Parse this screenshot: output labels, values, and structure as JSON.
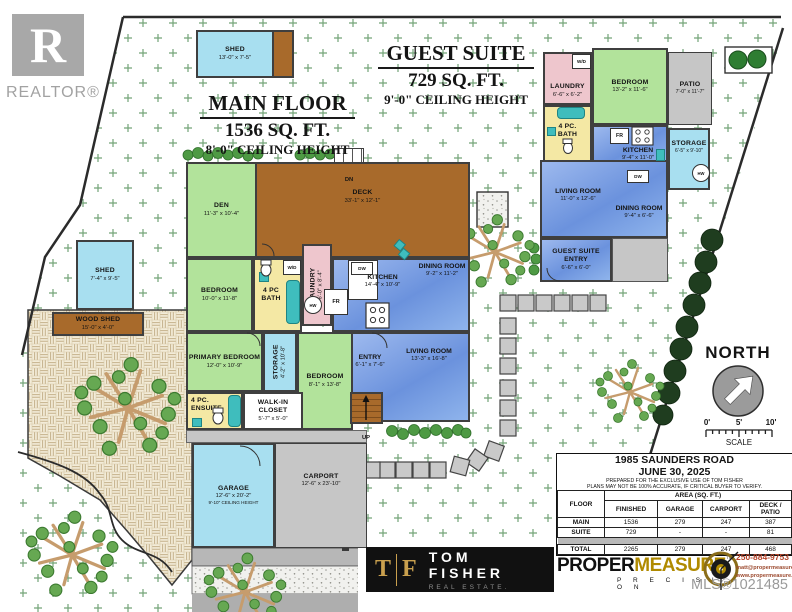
{
  "branding": {
    "realtor_r": "R",
    "realtor_word": "REALTOR®",
    "mls": "MLS®1021485",
    "tom_fisher": {
      "t": "T",
      "f": "F",
      "name": "TOM FISHER",
      "tagline": "REAL ESTATE."
    },
    "propermeasure": {
      "proper": "PROPER",
      "measure": "MEASURE",
      "tm": "™",
      "precision": "P R E C I S I O N"
    },
    "contact": {
      "phone": "250-884-9753",
      "email": "matt@propermeasure.com",
      "web": "www.propermeasure.com"
    }
  },
  "titles": {
    "main_floor": {
      "l1": "MAIN FLOOR",
      "l2": "1536 SQ. FT.",
      "l3": "8'-0\" CEILING HEIGHT"
    },
    "guest_suite": {
      "l1": "GUEST SUITE",
      "l2": "729 SQ. FT.",
      "l3": "9'-0\" CEILING HEIGHT"
    }
  },
  "compass": {
    "north": "NORTH",
    "scale": "SCALE",
    "ticks": [
      "0'",
      "5'",
      "10'"
    ]
  },
  "sheds": {
    "top": {
      "n": "SHED",
      "d": "13'-0\" x 7'-5\""
    },
    "left": {
      "n": "SHED",
      "d": "7'-4\" x 9'-5\""
    },
    "wood": {
      "n": "WOOD SHED",
      "d": "15'-0\" x 4'-0\""
    }
  },
  "main": {
    "den": {
      "n": "DEN",
      "d": "11'-3\" x 10'-4\""
    },
    "deck": {
      "n": "DECK",
      "d": "33'-1\" x 12'-1\"",
      "dn": "DN"
    },
    "bedroom": {
      "n": "BEDROOM",
      "d": "10'-0\" x 11'-8\""
    },
    "bath": {
      "n": "4 PC BATH"
    },
    "wd": "W/D",
    "hw": "HW",
    "fr": "FR",
    "dw": "DW",
    "up": "UP",
    "laundry": {
      "n": "LAUNDRY",
      "d": "6'-0\" x 8'-4\""
    },
    "kitchen": {
      "n": "KITCHEN",
      "d": "14'-4\" x 10'-9\""
    },
    "dining": {
      "n": "DINING ROOM",
      "d": "9'-2\" x 11'-2\""
    },
    "living": {
      "n": "LIVING ROOM",
      "d": "13'-3\" x 16'-8\""
    },
    "entry": {
      "n": "ENTRY",
      "d": "6'-1\" x 7'-6\""
    },
    "primary": {
      "n": "PRIMARY BEDROOM",
      "d": "12'-0\" x 10'-9\""
    },
    "storage": {
      "n": "STORAGE",
      "d": "4'-2\" x 10'-8\""
    },
    "bedroom2": {
      "n": "BEDROOM",
      "d": "8'-1\" x 13'-8\""
    },
    "ensuite": {
      "l1": "4 PC.",
      "l2": "ENSUITE"
    },
    "wic": {
      "n": "WALK-IN CLOSET",
      "d": "5'-7\" x 5'-0\""
    },
    "garage": {
      "n": "GARAGE",
      "d": "12'-6\" x 20'-2\"",
      "c": "9'-10\" CEILING HEIGHT"
    },
    "carport": {
      "n": "CARPORT",
      "d": "12'-6\" x 23'-10\""
    }
  },
  "guest": {
    "laundry": {
      "n": "LAUNDRY",
      "d": "6'-6\" x 6'-2\""
    },
    "wd": "W/D",
    "hw": "HW",
    "fr": "FR",
    "dw": "DW",
    "bedroom": {
      "n": "BEDROOM",
      "d": "13'-2\" x 11'-6\""
    },
    "patio": {
      "n": "PATIO",
      "d": "7'-0\" x 11'-7\""
    },
    "bath": {
      "n": "4 PC. BATH"
    },
    "kitchen": {
      "n": "KITCHEN",
      "d": "9'-4\" x 11'-0\""
    },
    "storage": {
      "n": "STORAGE",
      "d": "6'-5\" x 9'-10\""
    },
    "living": {
      "n": "LIVING ROOM",
      "d": "11'-0\" x 12'-6\""
    },
    "dining": {
      "n": "DINING ROOM",
      "d": "9'-4\" x 6'-6\""
    },
    "entry": {
      "n": "GUEST SUITE ENTRY",
      "d": "6'-6\" x 6'-0\""
    }
  },
  "table": {
    "address": "1985 SAUNDERS ROAD",
    "date": "JUNE 30, 2025",
    "note1": "PREPARED FOR THE EXCLUSIVE USE OF TOM FISHER",
    "note2": "PLANS MAY NOT BE 100% ACCURATE, IF CRITICAL BUYER TO VERIFY.",
    "floor_h": "FLOOR",
    "area_h": "AREA (SQ. FT.)",
    "cols": [
      "FINISHED",
      "GARAGE",
      "CARPORT",
      "DECK / PATIO"
    ],
    "rows": [
      {
        "label": "MAIN",
        "v": [
          "1536",
          "279",
          "247",
          "387"
        ]
      },
      {
        "label": "SUITE",
        "v": [
          "729",
          "-",
          "-",
          "81"
        ]
      },
      {
        "label": "TOTAL",
        "v": [
          "2265",
          "279",
          "247",
          "468"
        ]
      }
    ]
  }
}
